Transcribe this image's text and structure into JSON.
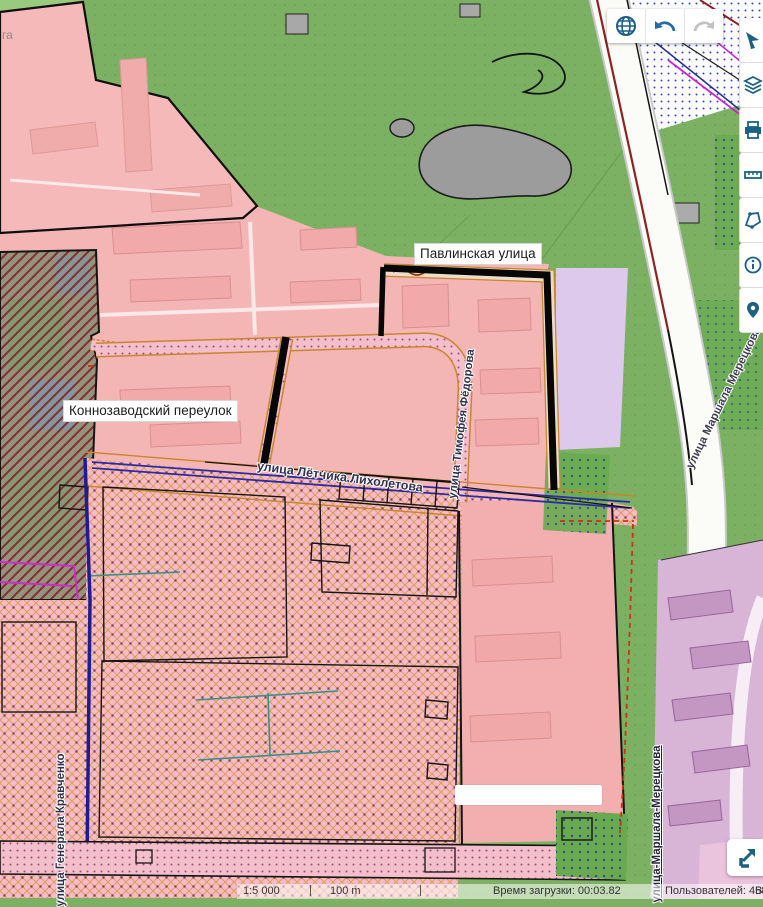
{
  "map": {
    "labels": {
      "pavlinskaya": "Павлинская улица",
      "konnozavodsky": "Коннозаводский переулок",
      "likholetova": "улица Лётчика Лихолетова",
      "fedorova": "улица Тимофея Фёдорова",
      "meretskova_diagonal": "улица Маршала Мерецкова",
      "meretskova_bottom": "улица-Маршала-Мерецкова",
      "kravchenko": "улица Генерала Кравченко",
      "edge_fragment": "га"
    },
    "colors": {
      "zone_pink": "#f4b5b5",
      "zone_green": "#7cb163",
      "zone_purple": "#d8b4d6",
      "zone_lavender": "#dcc9ec",
      "street_highlight": "#070707",
      "accent_blue": "#1d6086"
    }
  },
  "toolbar": {
    "buttons": [
      {
        "icon": "globe-icon"
      },
      {
        "icon": "undo-icon"
      },
      {
        "icon": "redo-icon"
      }
    ]
  },
  "sidebar": {
    "buttons": [
      {
        "icon": "cursor-arrow-icon"
      },
      {
        "icon": "layers-icon"
      },
      {
        "icon": "print-icon"
      },
      {
        "icon": "ruler-icon"
      },
      {
        "icon": "draw-polygon-icon"
      },
      {
        "icon": "info-icon"
      },
      {
        "icon": "marker-icon"
      }
    ]
  },
  "fullscreen_button": {
    "icon": "expand-icon"
  },
  "statusbar": {
    "scale": "1:5 000",
    "scale_distance": "100 m",
    "load_time": "Время загрузки: 00:03.82",
    "users": "Пользователей: 4584",
    "right_fragment": "В"
  }
}
